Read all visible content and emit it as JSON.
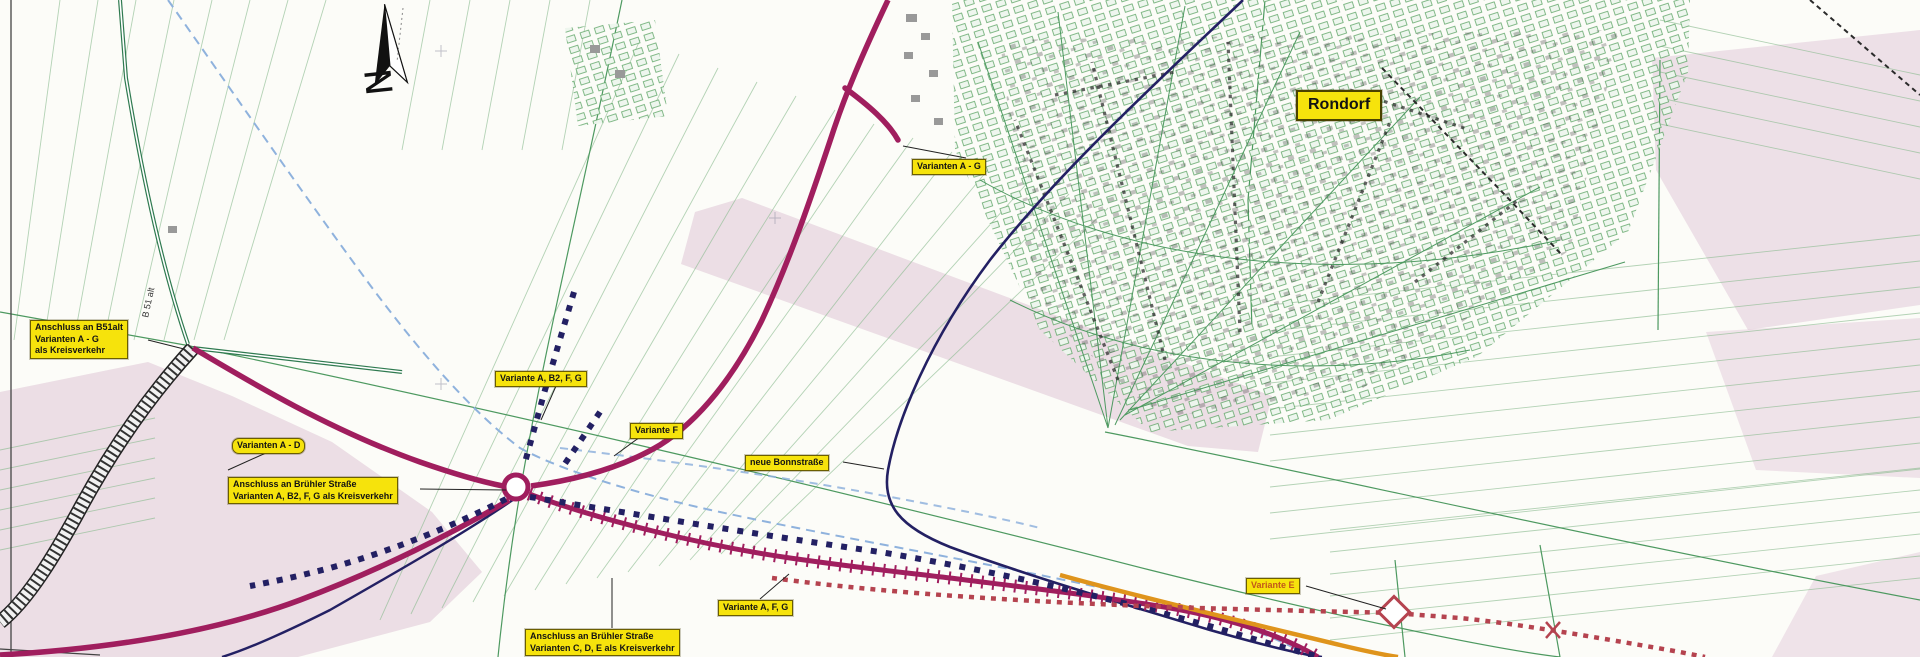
{
  "map": {
    "place_labels": {
      "rondorf": "Rondorf"
    },
    "north": {
      "letter": "N"
    },
    "road_ref": {
      "b51_alt": "B 51 alt"
    },
    "annotations": {
      "varianten_a_g": "Varianten A - G",
      "anschluss_b51": {
        "line1": "Anschluss an B51alt",
        "line2": "Varianten A - G",
        "line3": "als Kreisverkehr"
      },
      "varianten_a_d": "Varianten A - D",
      "anschluss_bruehler": {
        "line1": "Anschluss an Brühler Straße",
        "line2": "Varianten A, B2, F, G als Kreisverkehr"
      },
      "variante_a_b2_f_g": "Variante A, B2, F, G",
      "variante_f": "Variante F",
      "neue_bonnstrasse": "neue Bonnstraße",
      "variante_a_f_g": "Variante A, F, G",
      "anschluss_sued": {
        "line1": "Anschluss an Brühler Straße",
        "line2": "Varianten C, D, E als Kreisverkehr"
      },
      "variante_e": "Variante E"
    },
    "legend_colors": {
      "variant_route_magenta": "#a01e5e",
      "variant_route_navy": "#232063",
      "variant_route_red_dotted": "#b5434f",
      "variant_route_orange": "#df941c",
      "variant_route_blue_dashed": "#8fb2dd",
      "field_line_green": "#5fa567",
      "annotation_background_yellow": "#f6e30c",
      "built_up_area_pink": "#dcbfd2"
    }
  }
}
